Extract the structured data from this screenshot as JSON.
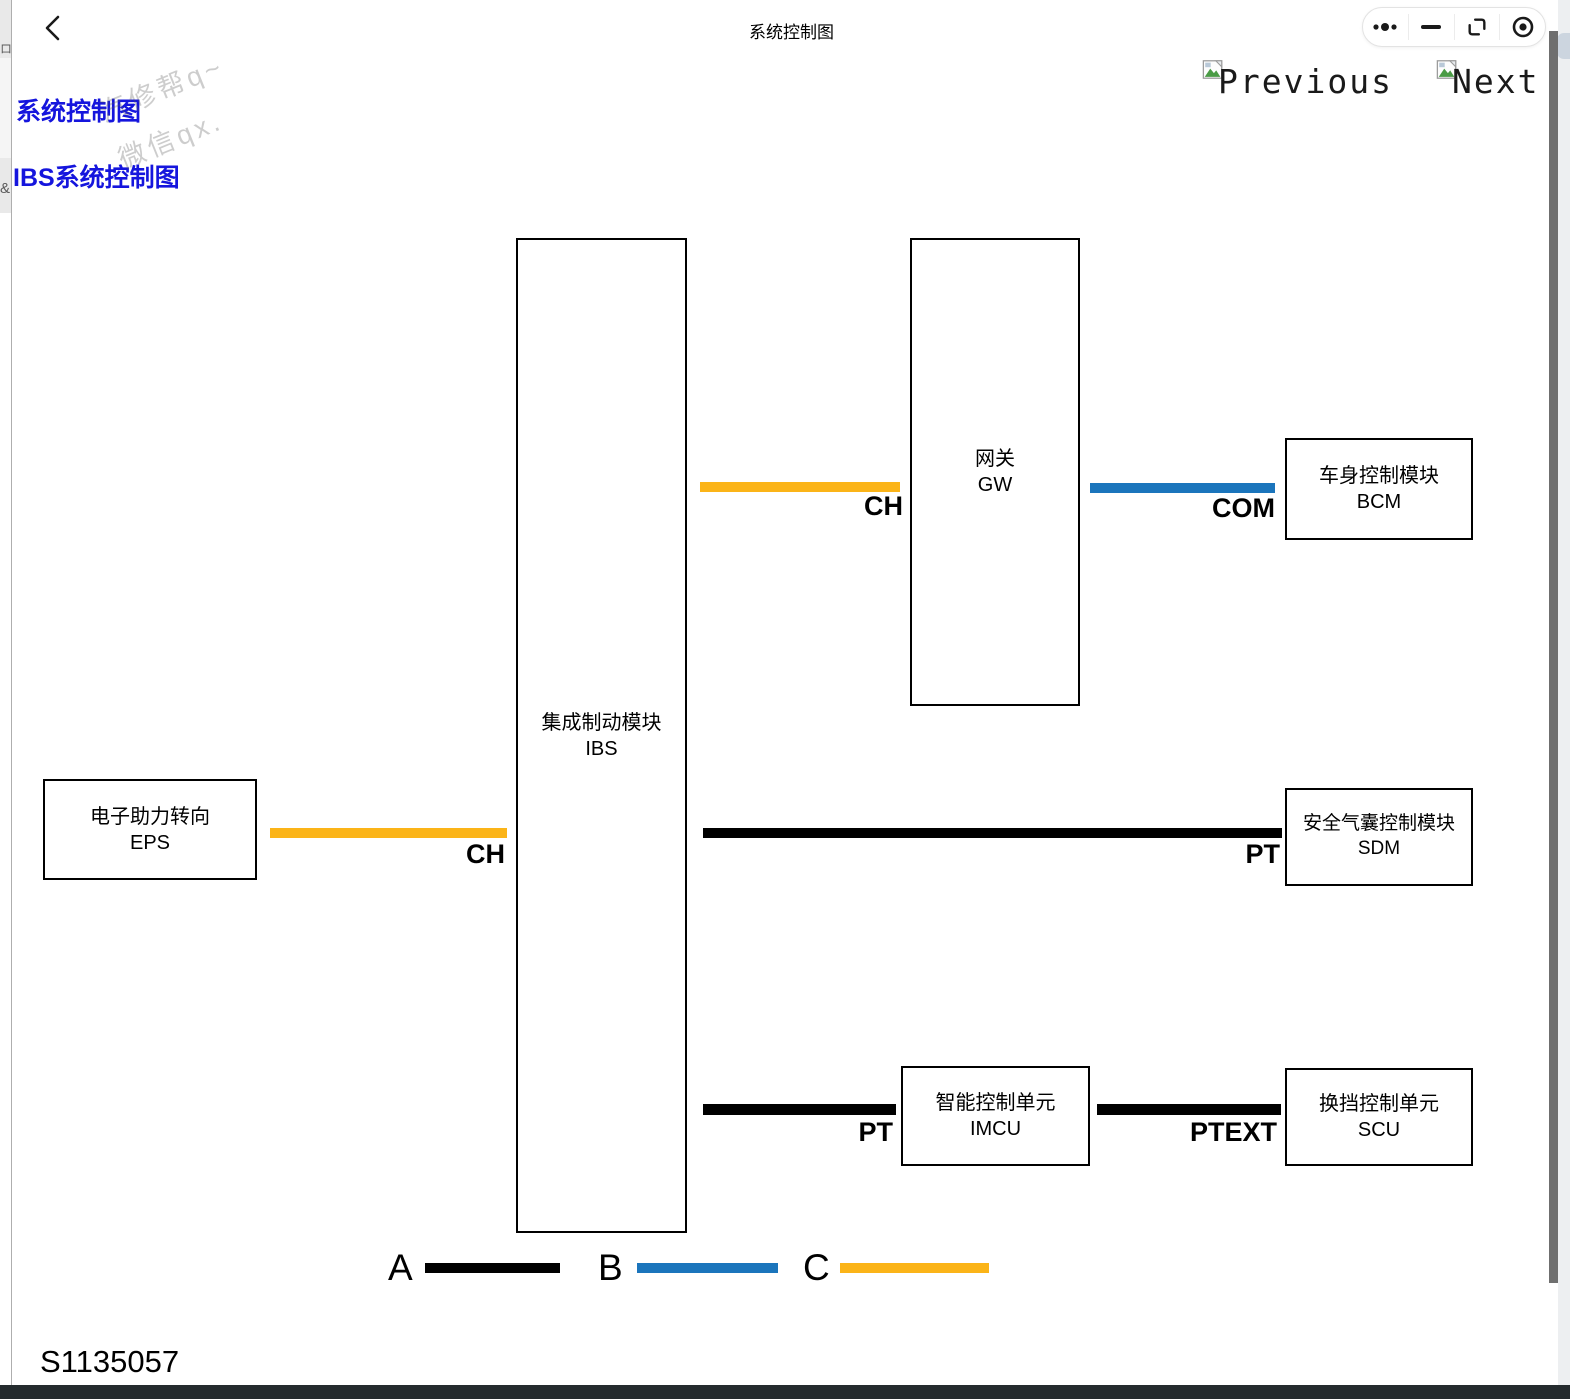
{
  "window": {
    "title": "系统控制图",
    "capsule_icons": [
      "more",
      "minimize",
      "restore",
      "exit-target"
    ]
  },
  "side_strip": {
    "fragment_top": "ロ/",
    "fragment_mid": "&"
  },
  "nav": {
    "previous": "Previous",
    "next": "Next"
  },
  "links": [
    {
      "label": "系统控制图"
    },
    {
      "label": "IBS系统控制图"
    }
  ],
  "watermark": {
    "line1": "汽修帮q~",
    "line2": "微信qx."
  },
  "figure_id": "S1135057",
  "colors": {
    "black": "#000000",
    "blue": "#1B75BC",
    "yellow": "#FBB418"
  },
  "diagram": {
    "nodes": [
      {
        "id": "eps",
        "name": "电子助力转向",
        "code": "EPS"
      },
      {
        "id": "ibs",
        "name": "集成制动模块",
        "code": "IBS"
      },
      {
        "id": "gw",
        "name": "网关",
        "code": "GW"
      },
      {
        "id": "bcm",
        "name": "车身控制模块",
        "code": "BCM"
      },
      {
        "id": "sdm",
        "name": "安全气囊控制模块",
        "code": "SDM"
      },
      {
        "id": "imcu",
        "name": "智能控制单元",
        "code": "IMCU"
      },
      {
        "id": "scu",
        "name": "换挡控制单元",
        "code": "SCU"
      }
    ],
    "connections": [
      {
        "from": "EPS",
        "to": "IBS",
        "label": "CH",
        "bus": "C"
      },
      {
        "from": "IBS",
        "to": "GW",
        "label": "CH",
        "bus": "C"
      },
      {
        "from": "GW",
        "to": "BCM",
        "label": "COM",
        "bus": "B"
      },
      {
        "from": "IBS",
        "to": "SDM",
        "label": "PT",
        "bus": "A"
      },
      {
        "from": "IBS",
        "to": "IMCU",
        "label": "PT",
        "bus": "A"
      },
      {
        "from": "IMCU",
        "to": "SCU",
        "label": "PTEXT",
        "bus": "A"
      }
    ],
    "legend": [
      {
        "label": "A",
        "color": "#000000"
      },
      {
        "label": "B",
        "color": "#1B75BC"
      },
      {
        "label": "C",
        "color": "#FBB418"
      }
    ]
  }
}
